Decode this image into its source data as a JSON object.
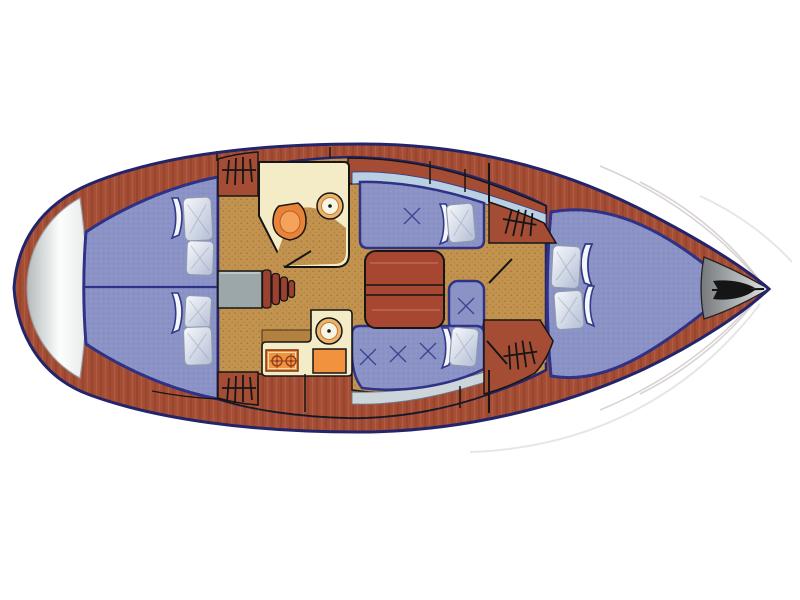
{
  "diagram": {
    "type": "sailboat-interior-floor-plan",
    "view": "overhead-deck-plan",
    "orientation": "bow-right-stern-left",
    "rooms": [
      {
        "name": "aft-double-cabin",
        "furniture": [
          "port-berth",
          "starboard-berth"
        ],
        "pillow_count": 4,
        "hanging_lockers": 2
      },
      {
        "name": "head-compartment",
        "furniture": [
          "toilet",
          "washbasin"
        ]
      },
      {
        "name": "navigation-area",
        "furniture": [
          "chart-table",
          "companionway-steps"
        ]
      },
      {
        "name": "saloon",
        "furniture": [
          "folding-table",
          "port-settee",
          "starboard-settee",
          "forward-seat"
        ],
        "pillow_count": 2,
        "cushion_button_count": 5
      },
      {
        "name": "galley",
        "furniture": [
          "round-sink",
          "two-burner-stove",
          "oven"
        ],
        "burner_count": 2
      },
      {
        "name": "forward-cabin",
        "furniture": [
          "v-berth"
        ],
        "pillow_count": 2,
        "hanging_lockers": 2
      },
      {
        "name": "bow-platform",
        "furniture": [
          "anchor"
        ]
      },
      {
        "name": "stern-transom",
        "furniture": []
      }
    ],
    "icons": [
      "hanging-locker-icon",
      "anchor-icon",
      "burner-icon",
      "sink-icon",
      "toilet-icon",
      "cushion-tuft-icon",
      "pillow-icon",
      "blanket-fold-icon"
    ],
    "totals": {
      "pillows": 8,
      "hanging_lockers": 4,
      "cushion_buttons": 5,
      "sinks": 2,
      "burners": 2
    },
    "colors": {
      "outline": "#23246a",
      "berth": "#8b93c6",
      "berthEdge": "#2e3185",
      "deck": "#a54d34",
      "table": "#a84731",
      "steps": "#9c4130",
      "chart": "#9ca7aa",
      "floor": "#c2924f",
      "cream": "#f4ecc6",
      "orange": "#f0923e",
      "liner": "#b9cfe2",
      "linerSilver": "#ccd5da",
      "pillowHi": "#f7f9fc",
      "pillowLo": "#b2bdd4",
      "white": "#ffffff",
      "transomDark": "#b4babc",
      "transomLight": "#fdfdfd",
      "bowDark": "#75797c",
      "bowLight": "#e3e6e6"
    }
  }
}
